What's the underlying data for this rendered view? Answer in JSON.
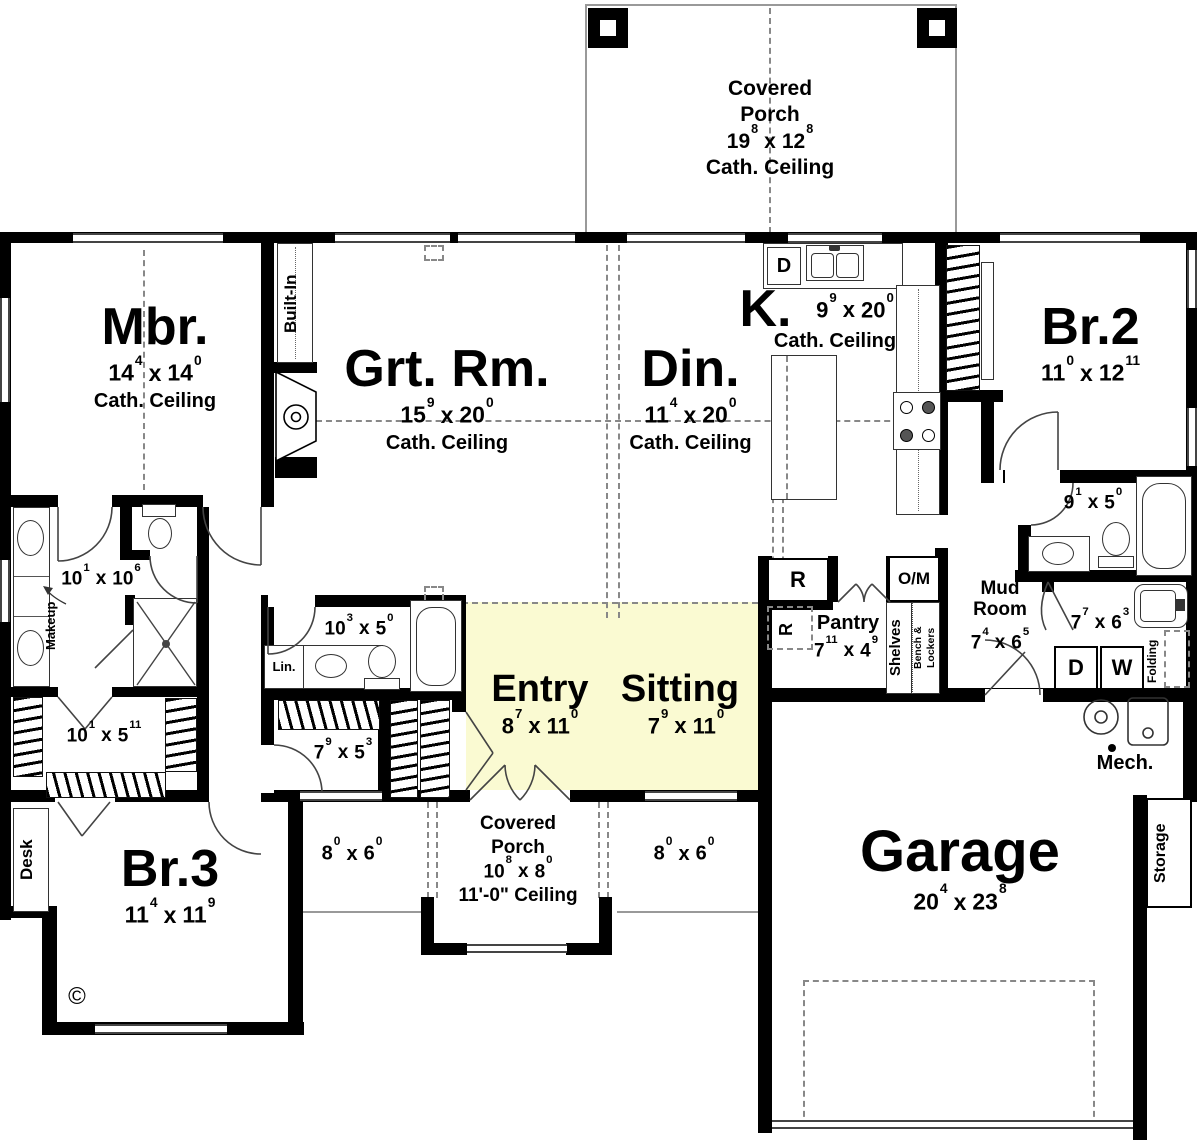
{
  "plan": {
    "colors": {
      "wall": "#000000",
      "highlight": "#FAFAD2"
    },
    "sep": "x",
    "rooms": {
      "porch_top": {
        "line1": "Covered",
        "line2": "Porch",
        "dim": {
          "a": "19",
          "as": "8",
          "b": "12",
          "bs": "8"
        },
        "note": "Cath. Ceiling"
      },
      "mbr": {
        "name": "Mbr.",
        "dim": {
          "a": "14",
          "as": "4",
          "b": "14",
          "bs": "0"
        },
        "note": "Cath. Ceiling"
      },
      "grt": {
        "name": "Grt. Rm.",
        "dim": {
          "a": "15",
          "as": "9",
          "b": "20",
          "bs": "0"
        },
        "note": "Cath. Ceiling"
      },
      "din": {
        "name": "Din.",
        "dim": {
          "a": "11",
          "as": "4",
          "b": "20",
          "bs": "0"
        },
        "note": "Cath. Ceiling"
      },
      "kitchen": {
        "name": "K.",
        "dim": {
          "a": "9",
          "as": "9",
          "b": "20",
          "bs": "0"
        },
        "note": "Cath. Ceiling"
      },
      "br2": {
        "name": "Br.2",
        "dim": {
          "a": "11",
          "as": "0",
          "b": "12",
          "bs": "11"
        }
      },
      "bath2": {
        "dim": {
          "a": "9",
          "as": "1",
          "b": "5",
          "bs": "0"
        }
      },
      "mud": {
        "line1": "Mud",
        "line2": "Room",
        "dim": {
          "a": "7",
          "as": "4",
          "b": "6",
          "bs": "5"
        }
      },
      "laundry": {
        "dim": {
          "a": "7",
          "as": "7",
          "b": "6",
          "bs": "3"
        }
      },
      "pantry": {
        "name": "Pantry",
        "dim": {
          "a": "7",
          "as": "11",
          "b": "4",
          "bs": "9"
        }
      },
      "entry": {
        "name": "Entry",
        "dim": {
          "a": "8",
          "as": "7",
          "b": "11",
          "bs": "0"
        }
      },
      "sitting": {
        "name": "Sitting",
        "dim": {
          "a": "7",
          "as": "9",
          "b": "11",
          "bs": "0"
        }
      },
      "master_bath": {
        "dim": {
          "a": "10",
          "as": "1",
          "b": "10",
          "bs": "6"
        }
      },
      "hall_bath": {
        "dim": {
          "a": "10",
          "as": "3",
          "b": "5",
          "bs": "0"
        }
      },
      "master_closet": {
        "dim": {
          "a": "10",
          "as": "1",
          "b": "5",
          "bs": "11"
        }
      },
      "hall_closet": {
        "dim": {
          "a": "7",
          "as": "9",
          "b": "5",
          "bs": "3"
        }
      },
      "br3": {
        "name": "Br.3",
        "dim": {
          "a": "11",
          "as": "4",
          "b": "11",
          "bs": "9"
        }
      },
      "garage": {
        "name": "Garage",
        "dim": {
          "a": "20",
          "as": "4",
          "b": "23",
          "bs": "8"
        }
      },
      "porch_front": {
        "line1": "Covered",
        "line2": "Porch",
        "dim": {
          "a": "10",
          "as": "8",
          "b": "8",
          "bs": "0"
        },
        "note": "11'-0\" Ceiling"
      },
      "porch_left": {
        "dim": {
          "a": "8",
          "as": "0",
          "b": "6",
          "bs": "0"
        }
      },
      "porch_right": {
        "dim": {
          "a": "8",
          "as": "0",
          "b": "6",
          "bs": "0"
        }
      }
    },
    "labels": {
      "built_in": "Built-In",
      "makeup": "Makeup",
      "lin": "Lin.",
      "desk": "Desk",
      "storage": "Storage",
      "mech": "Mech.",
      "shelves": "Shelves",
      "bench1": "Bench &",
      "bench2": "Lockers",
      "folding": "Folding",
      "dishwasher": "D",
      "dryer": "D",
      "washer": "W",
      "fridge": "R",
      "fridge_alt": "R",
      "oven_micro": "O/M",
      "copyright": "©"
    }
  }
}
